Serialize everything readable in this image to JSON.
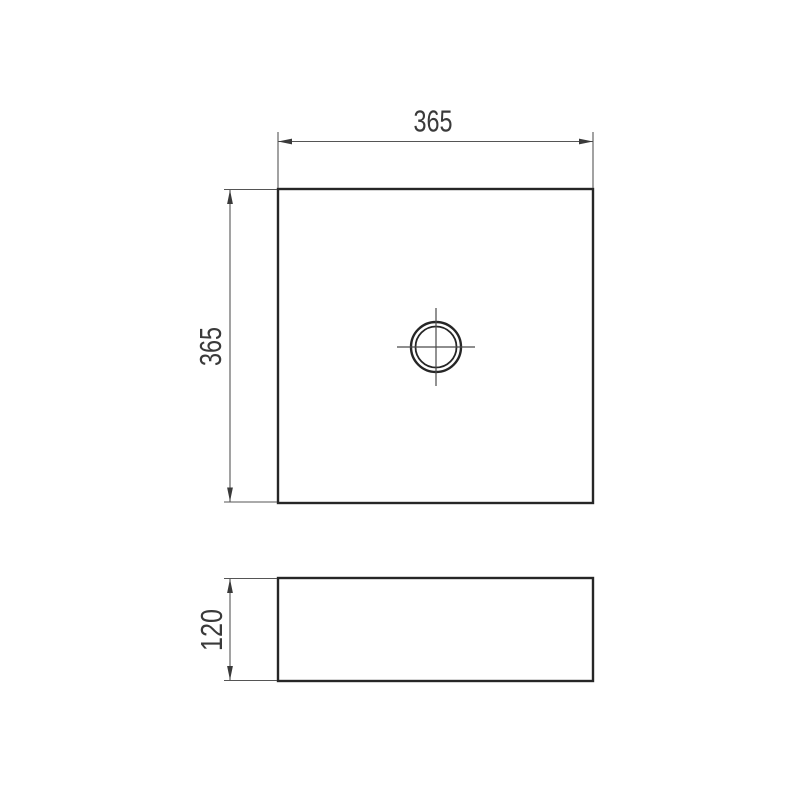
{
  "drawing": {
    "type": "technical-dimension-drawing",
    "views": {
      "top_view": {
        "shape": "square-basin-top-view-with-center-drain",
        "width_label": "365",
        "height_label": "365"
      },
      "side_view": {
        "shape": "basin-side-profile",
        "height_label": "120"
      }
    },
    "colors": {
      "outline": "#262626",
      "dimension_line": "#555555",
      "text": "#3a3a3a",
      "background": "#ffffff"
    }
  }
}
